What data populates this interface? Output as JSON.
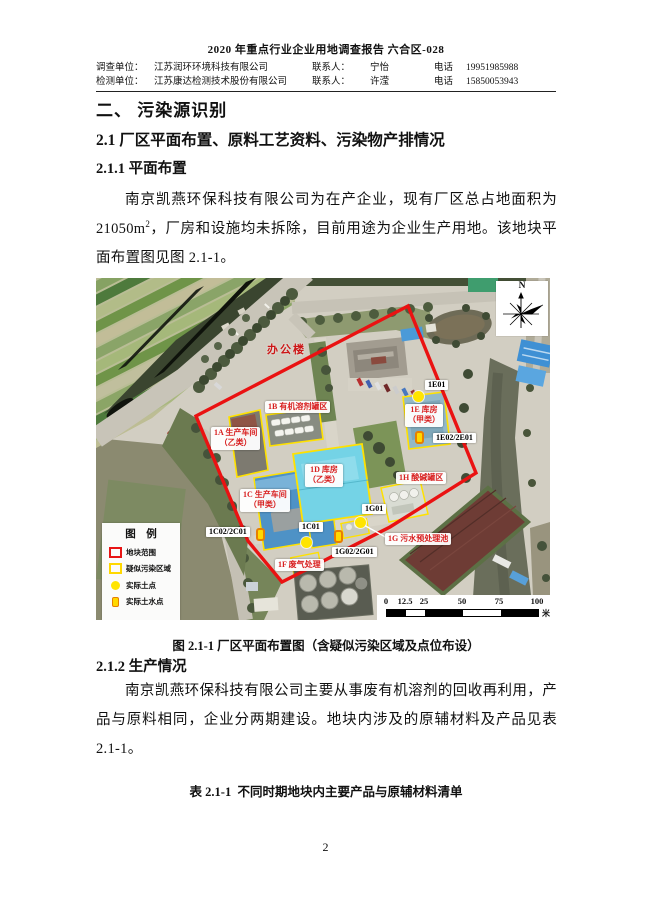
{
  "header": {
    "title": "2020 年重点行业企业用地调查报告 六合区-028",
    "rows": [
      {
        "label": "调查单位：",
        "value": "江苏润环环境科技有限公司",
        "contact_label": "联系人：",
        "contact": "宁怡",
        "phone_label": "电话",
        "phone": "19951985988"
      },
      {
        "label": "检测单位：",
        "value": "江苏康达检测技术股份有限公司",
        "contact_label": "联系人：",
        "contact": "许滢",
        "phone_label": "电话",
        "phone": "15850053943"
      }
    ]
  },
  "headings": {
    "h1": "二、 污染源识别",
    "h2": "2.1 厂区平面布置、原料工艺资料、污染物产排情况",
    "h3a": "2.1.1 平面布置",
    "h3b": "2.1.2 生产情况"
  },
  "paragraphs": {
    "p1_a": "南京凯燕环保科技有限公司为在产企业，现有厂区总占地面积为21050m",
    "p1_sup": "2",
    "p1_b": "，厂房和设施均未拆除，目前用途为企业生产用地。该地块平面布置图见图 2.1-1。",
    "p2": "南京凯燕环保科技有限公司主要从事废有机溶剂的回收再利用，产品与原料相同，企业分两期建设。地块内涉及的原辅材料及产品见表 2.1-1。"
  },
  "figure": {
    "caption": "图 2.1-1 厂区平面布置图（含疑似污染区域及点位布设）",
    "map": {
      "north": "N",
      "office_label": "办公楼",
      "area_labels": [
        {
          "text": "1A 生产车间\n（乙类）"
        },
        {
          "text": "1B 有机溶剂罐区"
        },
        {
          "text": "1C 生产车间\n（甲类）"
        },
        {
          "text": "1D 库房\n（乙类）"
        },
        {
          "text": "1E 库房\n（甲类）"
        },
        {
          "text": "1F 废气处理"
        },
        {
          "text": "1G 污水预处理池"
        },
        {
          "text": "1H 酸碱罐区"
        }
      ],
      "point_labels": [
        {
          "text": "1E01"
        },
        {
          "text": "1E02/2E01"
        },
        {
          "text": "1C01"
        },
        {
          "text": "1C02/2C01"
        },
        {
          "text": "1G01"
        },
        {
          "text": "1G02/2G01"
        }
      ],
      "legend": {
        "title": "图 例",
        "items": [
          {
            "label": "地块范围",
            "symbol": "red-rect"
          },
          {
            "label": "疑似污染区域",
            "symbol": "yellow-rect"
          },
          {
            "label": "实际土点",
            "symbol": "yellow-dot"
          },
          {
            "label": "实际土水点",
            "symbol": "yellow-cylinder"
          }
        ]
      },
      "scale": {
        "ticks": [
          "0",
          "12.5",
          "25",
          "50",
          "75",
          "100"
        ],
        "unit": "米"
      },
      "colors": {
        "boundary": "#ea1212",
        "suspect_area": "#ffe100",
        "sample_point": "#ffe400",
        "label_red": "#d81f1f"
      }
    }
  },
  "table": {
    "caption": "表 2.1-1  不同时期地块内主要产品与原辅材料清单"
  },
  "page": {
    "number": "2"
  }
}
